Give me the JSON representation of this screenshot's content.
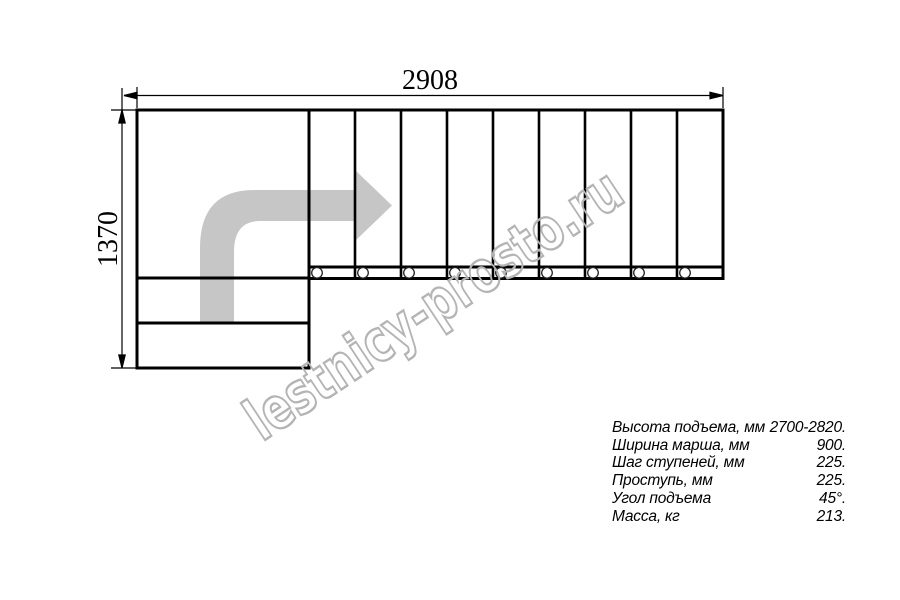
{
  "diagram": {
    "width_dimension_label": "2908",
    "height_dimension_label": "1370",
    "watermark_text": "lestnicy-prosto.ru",
    "flight_step_count": 9,
    "lower_step_count": 2,
    "fastener_marker_count": 9,
    "colors": {
      "line": "#000000",
      "direction_arrow": "#c6c6c6",
      "watermark": "#b4b4b4"
    }
  },
  "specs": {
    "rows": [
      {
        "label": "Высота подъема, мм",
        "value": "2700-2820."
      },
      {
        "label": "Ширина марша, мм",
        "value": "900."
      },
      {
        "label": "Шаг ступеней, мм",
        "value": "225."
      },
      {
        "label": "Проступь, мм",
        "value": "225."
      },
      {
        "label": "Угол подъема",
        "value": "45°."
      },
      {
        "label": "Масса, кг",
        "value": "213."
      }
    ]
  }
}
